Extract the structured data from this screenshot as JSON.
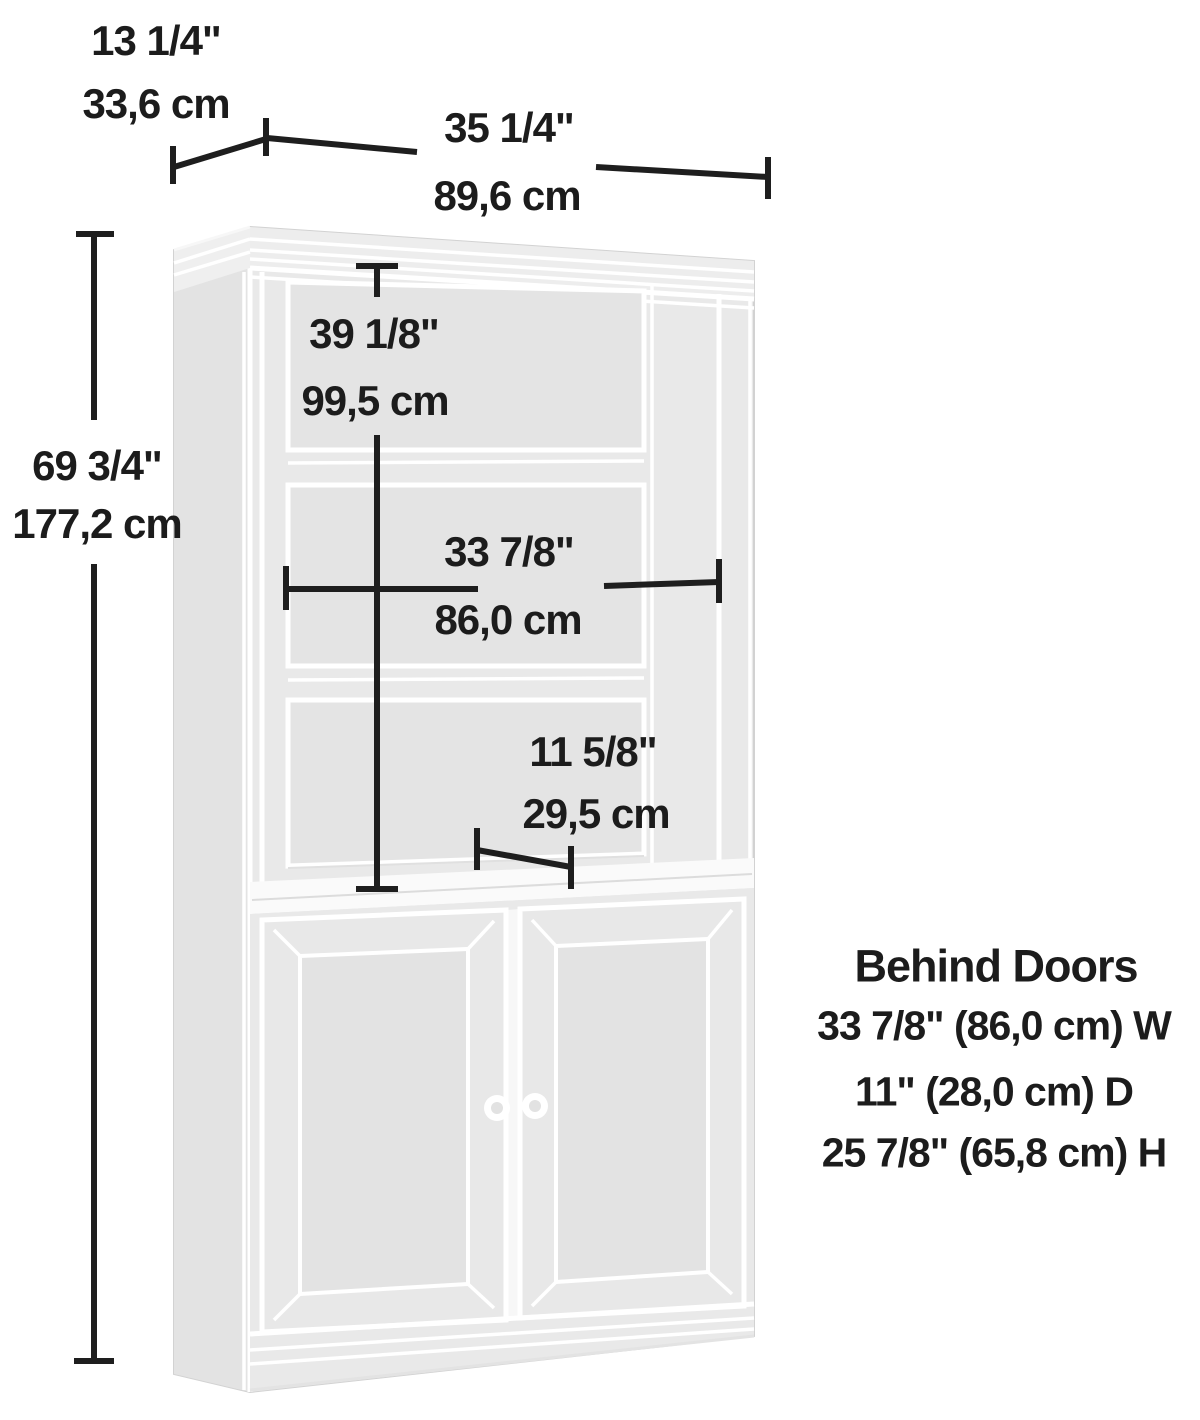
{
  "diagram": {
    "type": "furniture-dimension-diagram",
    "subject": "storage cabinet with hutch and lower doors",
    "colors": {
      "background": "#ffffff",
      "cabinet_fill": "#e9e9e9",
      "cabinet_side_fill": "#e3e3e3",
      "opening_fill": "#e4e4e4",
      "panel_line": "#ffffff",
      "dimension_line": "#1e1e1e",
      "text": "#1c1c1c"
    },
    "dims": {
      "depth_in": "13 1/4\"",
      "depth_cm": "33,6 cm",
      "width_in": "35 1/4\"",
      "width_cm": "89,6 cm",
      "height_in": "69 3/4\"",
      "height_cm": "177,2 cm",
      "hutch_in": "39 1/8\"",
      "hutch_cm": "99,5 cm",
      "interior_in": "33 7/8\"",
      "interior_cm": "86,0 cm",
      "shelf_in": "11 5/8\"",
      "shelf_cm": "29,5 cm"
    },
    "behind_doors": {
      "title": "Behind Doors",
      "line_w": "33 7/8\" (86,0 cm) W",
      "line_d": "11\" (28,0 cm) D",
      "line_h": "25 7/8\" (65,8 cm) H"
    }
  }
}
